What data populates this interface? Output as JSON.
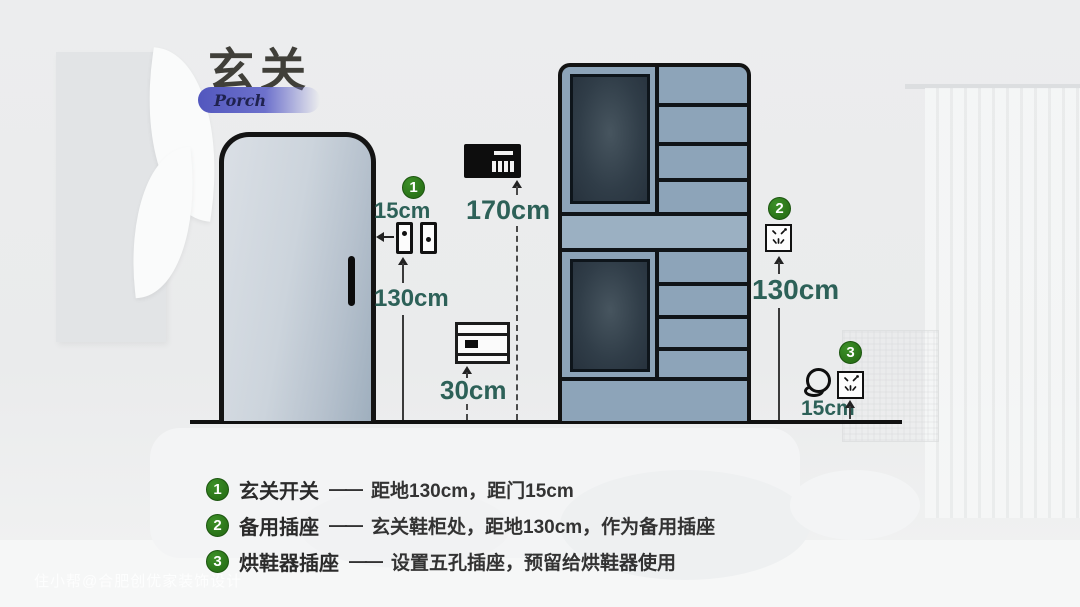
{
  "header": {
    "title": "玄关",
    "subtitle": "Porch"
  },
  "colors": {
    "marker_green": "#2a7318",
    "measure_teal": "#2d6158",
    "badge_purple": "#5257be",
    "cabinet_blue": "#8da4b9"
  },
  "icons": {
    "switch": "wall-switch-icon",
    "five_hole_socket": "five-hole-socket-icon",
    "doorbell_panel": "doorbell-panel-icon",
    "floor_socket_box": "socket-box-icon",
    "shoe_dryer": "shoe-dryer-icon"
  },
  "annotations": {
    "switch_group": {
      "marker": "1",
      "door_gap": "15cm",
      "height": "130cm"
    },
    "doorbell": {
      "height": "170cm"
    },
    "floor_box": {
      "height": "30cm"
    },
    "spare_socket": {
      "marker": "2",
      "height": "130cm"
    },
    "dryer_socket": {
      "marker": "3",
      "height": "15cm"
    }
  },
  "legend": {
    "items": [
      {
        "number": "1",
        "label": "玄关开关",
        "dash": "——",
        "desc": "距地130cm，距门15cm"
      },
      {
        "number": "2",
        "label": "备用插座",
        "dash": "——",
        "desc": "玄关鞋柜处，距地130cm，作为备用插座"
      },
      {
        "number": "3",
        "label": "烘鞋器插座",
        "dash": "——",
        "desc": "设置五孔插座，预留给烘鞋器使用"
      }
    ]
  },
  "watermark": "住小帮@合肥创优家装饰设计"
}
